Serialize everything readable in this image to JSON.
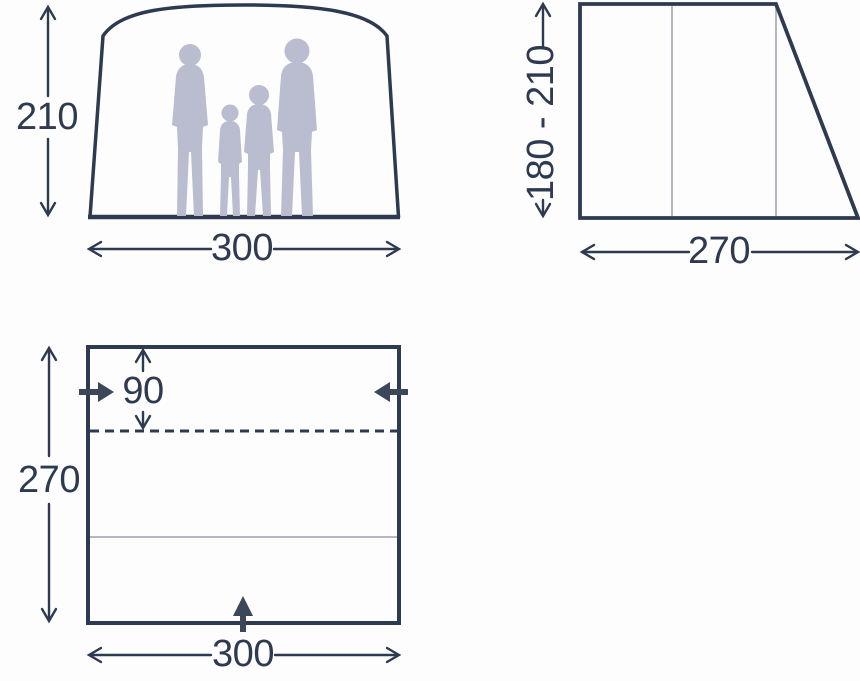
{
  "front_view": {
    "height": "210",
    "width": "300"
  },
  "side_view": {
    "height_range": "180 - 210",
    "depth": "270"
  },
  "floor_plan": {
    "door_offset": "90",
    "depth": "270",
    "width": "300"
  },
  "icons": {
    "family_silhouette": "family-of-four-silhouette",
    "entrance_left": "entrance-arrow-left-wall",
    "entrance_right": "entrance-arrow-right-wall",
    "entrance_front": "entrance-arrow-front-wall"
  },
  "colors": {
    "line": "#2e3a50",
    "solid_arrow": "#3c4759",
    "silhouette": "#b9bdcf",
    "thin_line": "#9ba1ab",
    "background": "#fdfdfe"
  }
}
